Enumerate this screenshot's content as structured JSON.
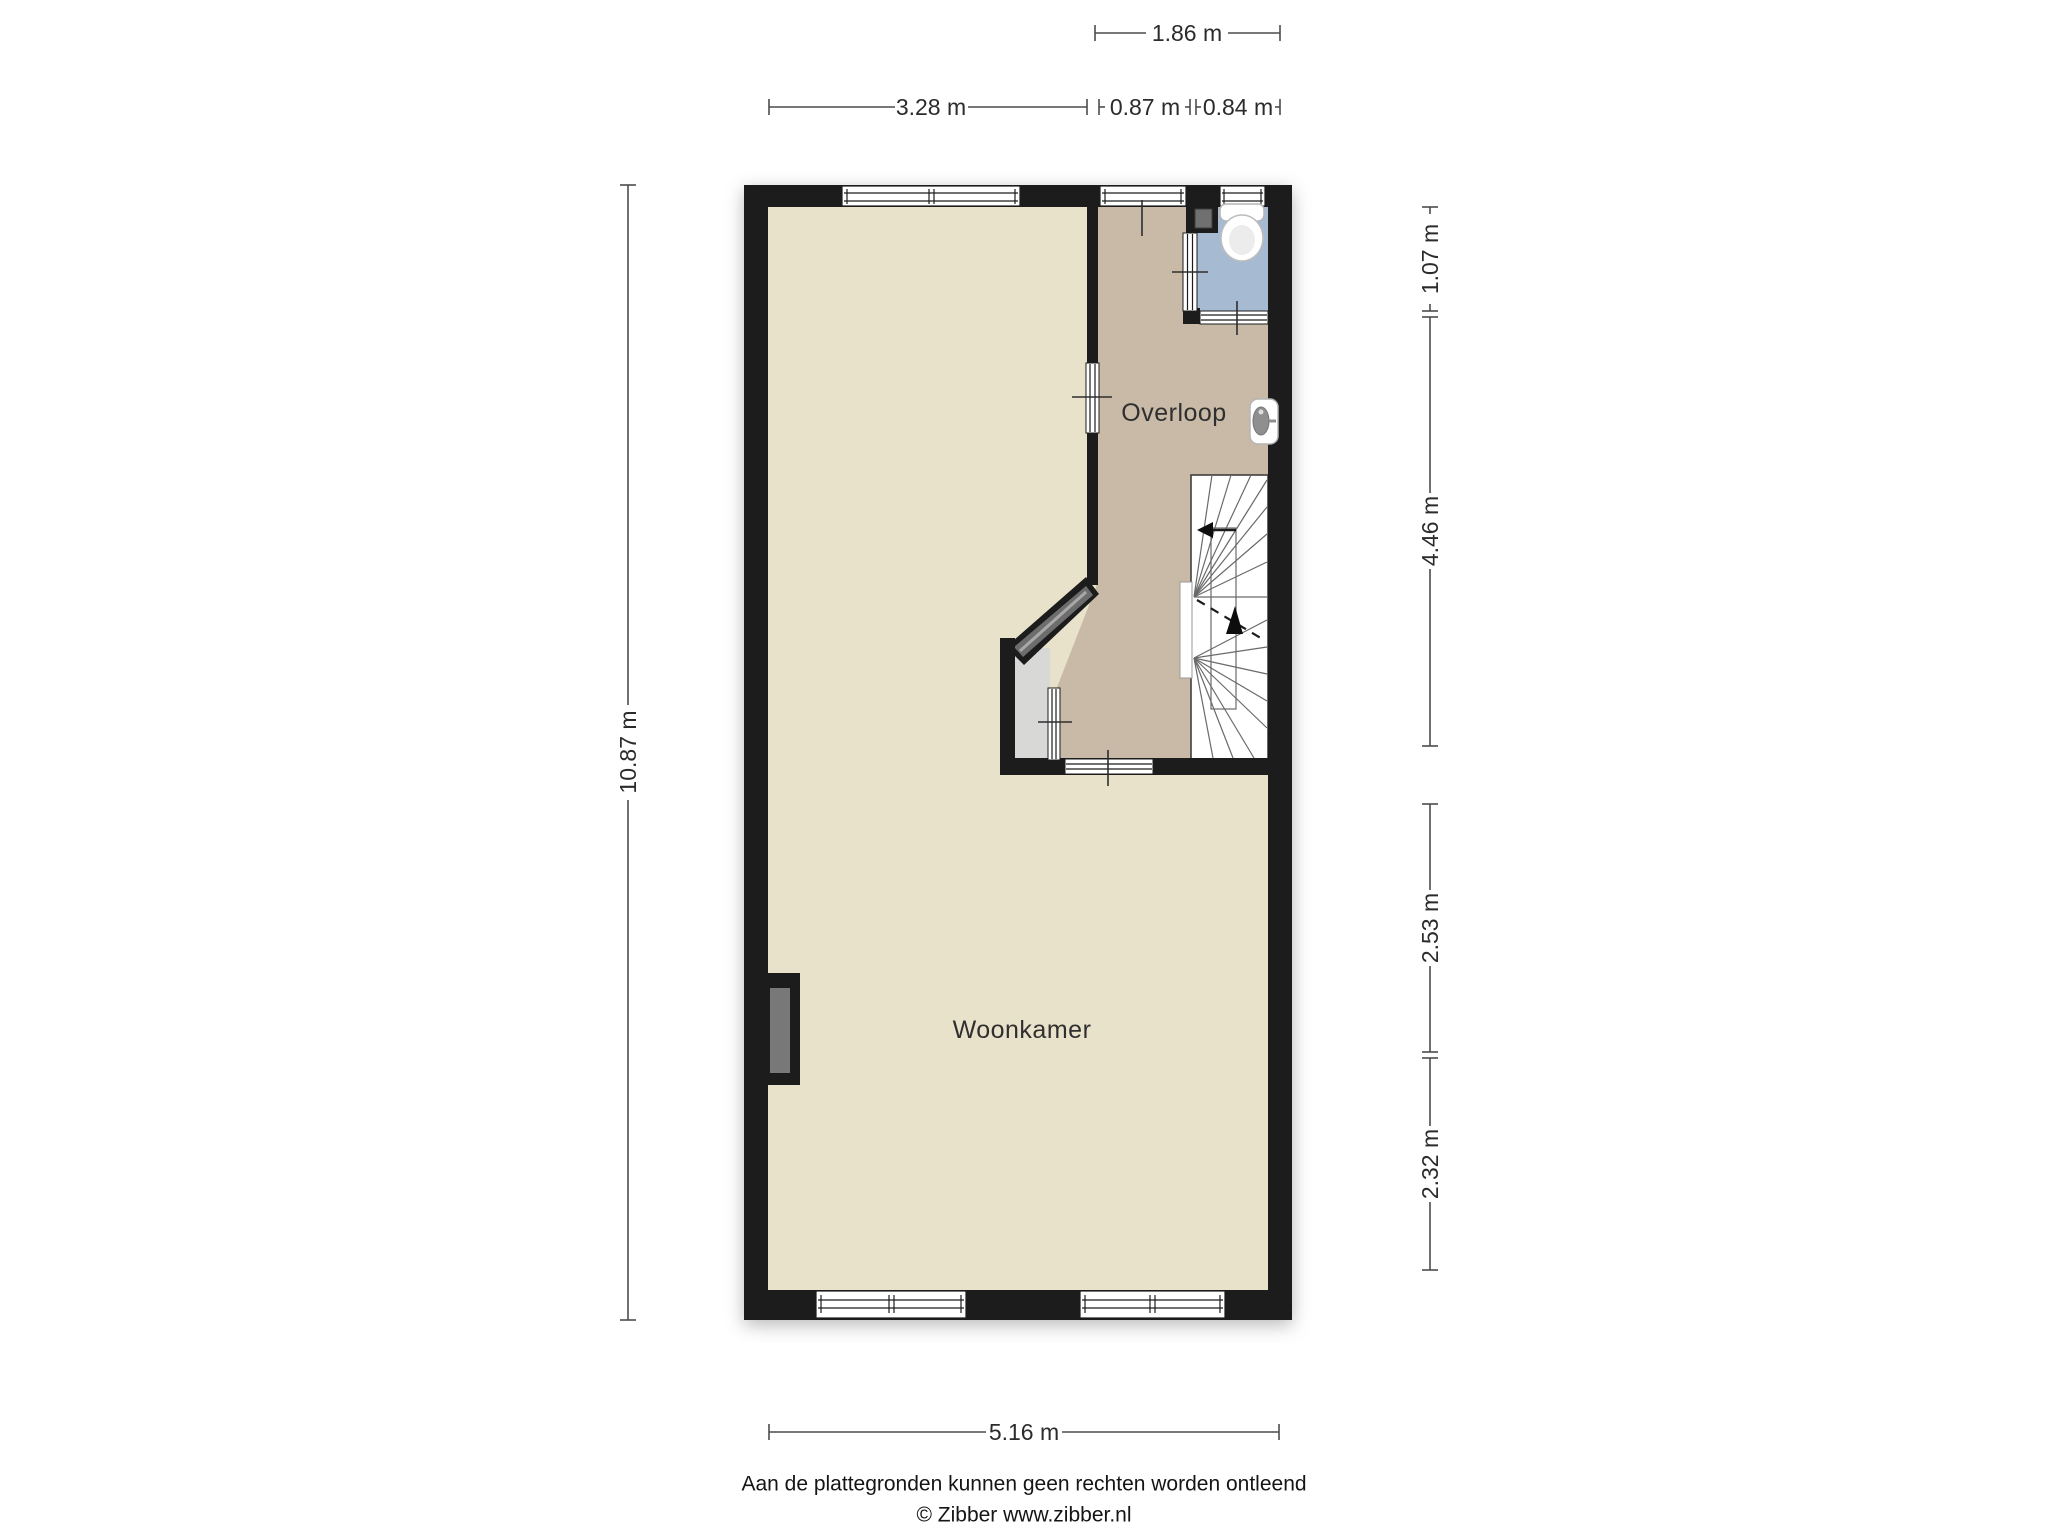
{
  "plan": {
    "rooms": {
      "overloop": {
        "label": "Overloop"
      },
      "woonkamer": {
        "label": "Woonkamer"
      }
    },
    "fixtures": {
      "toilet": "toilet-icon",
      "shower_room": "shower-room",
      "sink": "sink-icon",
      "stairs": "stairs-icon",
      "entry_door": "entry-door-icon",
      "chimney": "chimney-icon",
      "closet": "closet"
    },
    "colors": {
      "wall": "#1c1c1c",
      "woonkamer_floor": "#e9e2ca",
      "overloop_floor": "#c8baa7",
      "toilet_floor": "#a6bad2",
      "closet_floor": "#d8d8d6",
      "stairs": "#ffffff",
      "door_panel": "#787878",
      "dimension_line": "#4c4c4c",
      "dimension_text": "#2b2b2b",
      "room_text": "#2f2f2f"
    }
  },
  "dims": {
    "top1": [
      {
        "label": "1.86 m"
      }
    ],
    "top2": [
      {
        "label": "3.28 m"
      },
      {
        "label": "0.87 m"
      },
      {
        "label": "0.84 m"
      }
    ],
    "left": [
      {
        "label": "10.87 m"
      }
    ],
    "right": [
      {
        "label": "1.07 m"
      },
      {
        "label": "4.46 m"
      },
      {
        "label": "2.53 m"
      },
      {
        "label": "2.32 m"
      }
    ],
    "bottom": [
      {
        "label": "5.16 m"
      }
    ]
  },
  "footer": {
    "disclaimer": "Aan de plattegronden kunnen geen rechten worden ontleend",
    "copyright": "© Zibber www.zibber.nl"
  }
}
